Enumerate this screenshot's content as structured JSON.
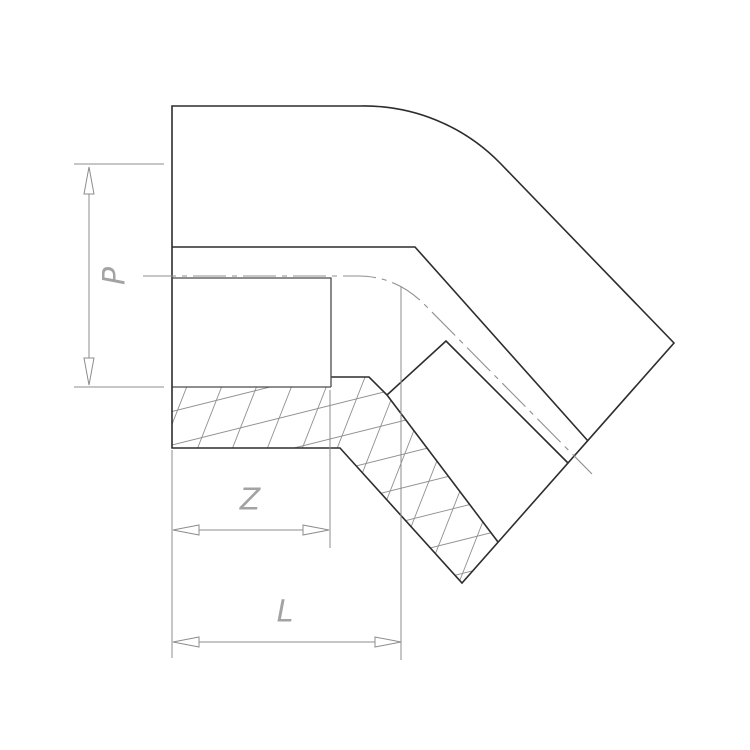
{
  "drawing": {
    "description": "Technical line drawing of a 45-degree socket elbow pipe fitting shown in half-section with cross-hatched walls",
    "dimensions": [
      {
        "id": "p",
        "label": "P",
        "orientation": "vertical",
        "measures": "socket bore diameter"
      },
      {
        "id": "z",
        "label": "Z",
        "orientation": "horizontal",
        "measures": "socket depth"
      },
      {
        "id": "l",
        "label": "L",
        "orientation": "horizontal",
        "measures": "overall laying length"
      }
    ],
    "colors": {
      "background": "#ffffff",
      "profile": "#2d2d2d",
      "medium": "#4a4a4a",
      "thin": "#8c8c8c",
      "hatch": "#909090",
      "centerline": "#8f8f8f",
      "label": "#a3a3a3"
    }
  }
}
